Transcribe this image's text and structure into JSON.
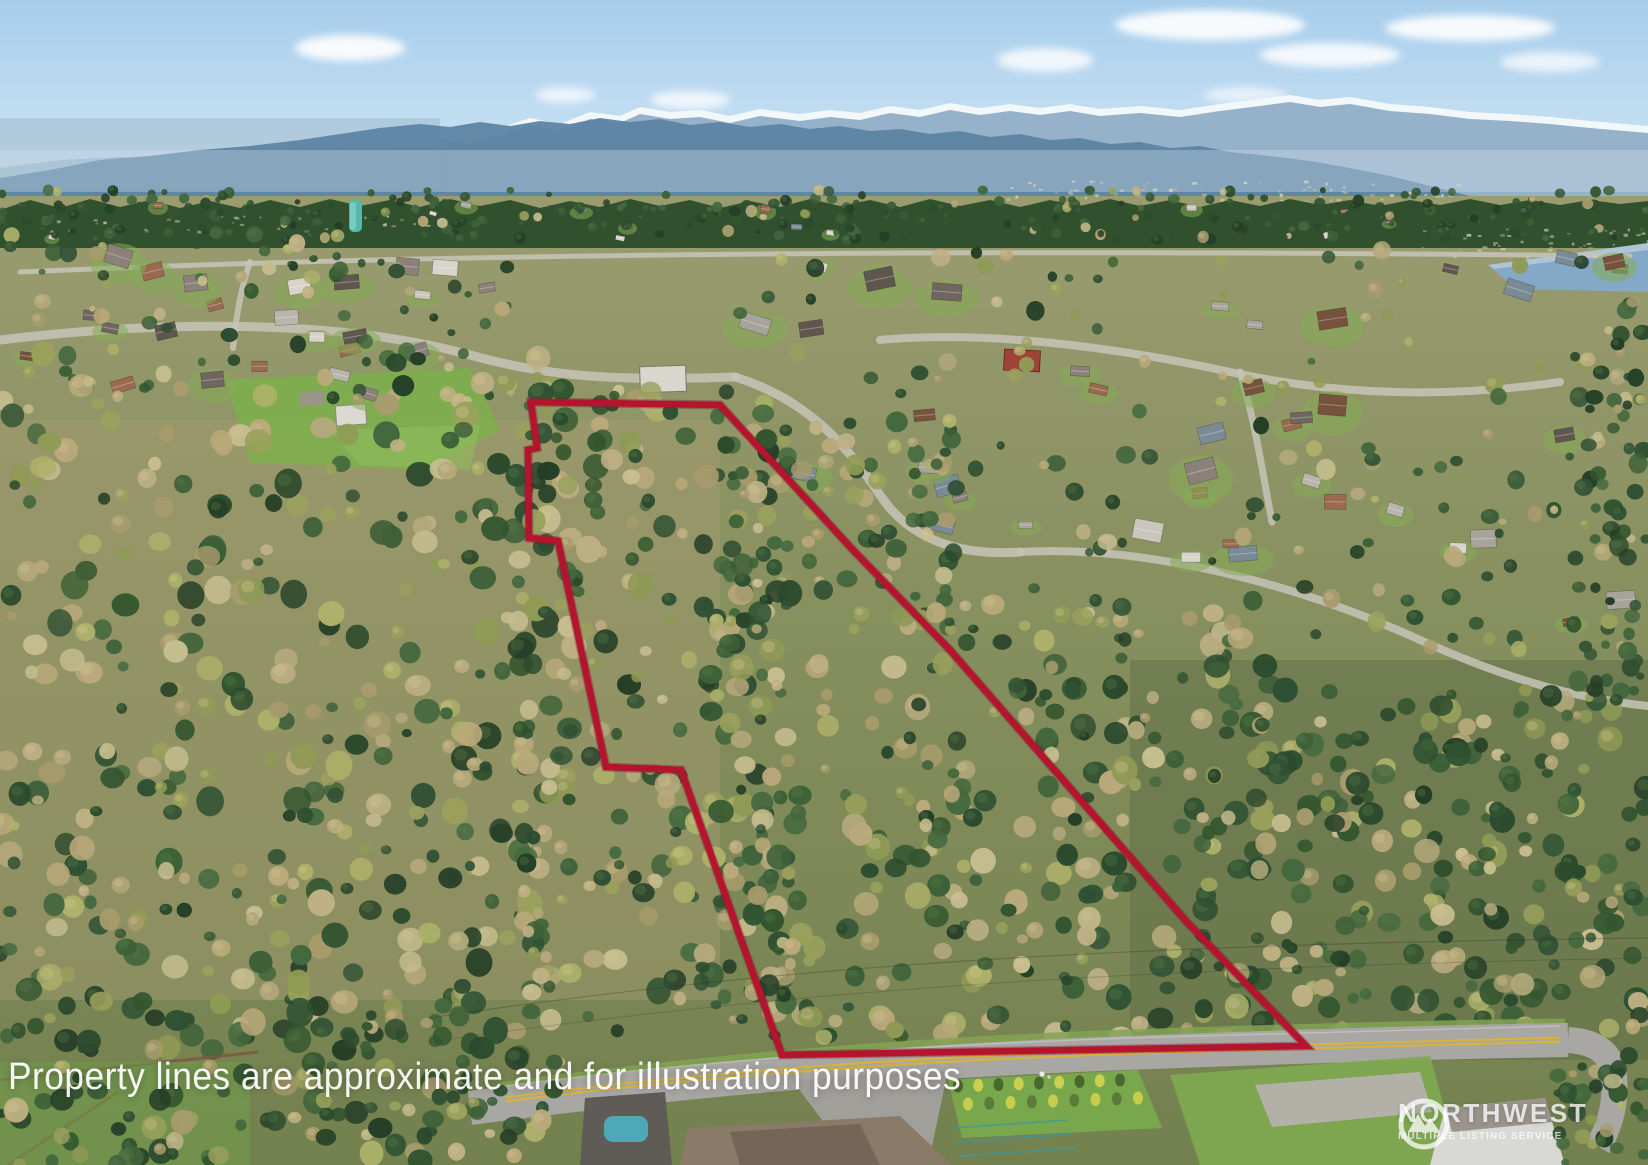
{
  "overlay": {
    "disclaimer": "Property lines are approximate and for illustration purposes"
  },
  "watermark": {
    "name": "NORTHWEST",
    "tagline": "MULTIPLE LISTING SERVICE"
  },
  "boundary": {
    "color": "#b5142f",
    "points": "531,402 720,405 853,550 950,650 1185,920 1306,1046 782,1055 681,770 606,767 558,541 529,538 528,450 537,448"
  }
}
